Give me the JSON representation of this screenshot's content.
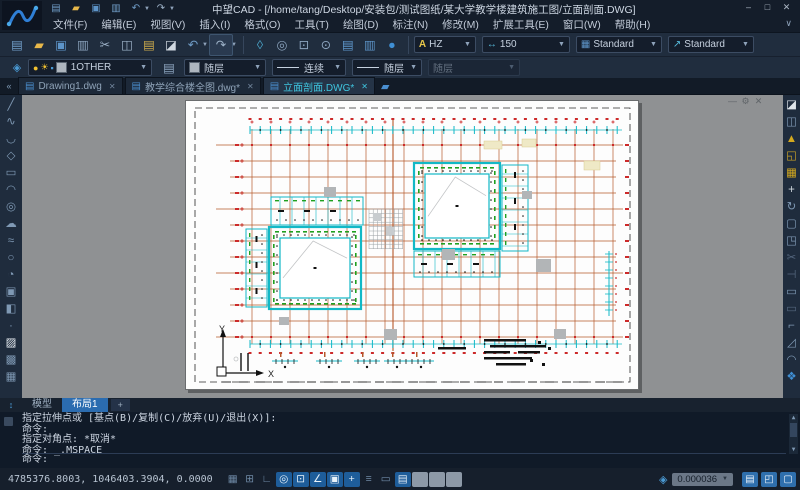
{
  "window": {
    "title": "中望CAD - [/home/tang/Desktop/安装包/测试图纸/某大学教学楼建筑施工图/立面剖面.DWG]",
    "controls": {
      "minimize": "–",
      "maximize": "□",
      "close": "✕"
    }
  },
  "quick_access": [
    {
      "id": "new-file",
      "g": "▤",
      "c": "#6f9cc6"
    },
    {
      "id": "open",
      "g": "▰",
      "c": "#e8b84a"
    },
    {
      "id": "save",
      "g": "▣",
      "c": "#5d94c8"
    },
    {
      "id": "plot",
      "g": "▥",
      "c": "#6f9cc6"
    },
    {
      "id": "undo",
      "g": "↶",
      "c": "#6f9cc6",
      "dd": true
    },
    {
      "id": "redo",
      "g": "↷",
      "c": "#9db2c8",
      "dd": true
    }
  ],
  "menu": {
    "items": [
      {
        "id": "file",
        "label": "文件(F)"
      },
      {
        "id": "edit",
        "label": "编辑(E)"
      },
      {
        "id": "view",
        "label": "视图(V)"
      },
      {
        "id": "insert",
        "label": "插入(I)"
      },
      {
        "id": "format",
        "label": "格式(O)"
      },
      {
        "id": "tools",
        "label": "工具(T)"
      },
      {
        "id": "draw",
        "label": "绘图(D)"
      },
      {
        "id": "dimension",
        "label": "标注(N)"
      },
      {
        "id": "modify",
        "label": "修改(M)"
      },
      {
        "id": "express",
        "label": "扩展工具(E)"
      },
      {
        "id": "window",
        "label": "窗口(W)"
      },
      {
        "id": "help",
        "label": "帮助(H)"
      }
    ]
  },
  "toolbar2": {
    "icons": [
      {
        "id": "new-file",
        "g": "▤",
        "c": "#6f9cc6"
      },
      {
        "id": "open",
        "g": "▰",
        "c": "#e8b84a"
      },
      {
        "id": "save",
        "g": "▣",
        "c": "#5d94c8"
      },
      {
        "id": "plot",
        "g": "▥",
        "c": "#8ba3bd"
      },
      {
        "id": "cut",
        "g": "✂",
        "c": "#9db2c8"
      },
      {
        "id": "copy",
        "g": "◫",
        "c": "#9db2c8"
      },
      {
        "id": "paste",
        "g": "▤",
        "c": "#c9a84c"
      },
      {
        "id": "match-properties",
        "g": "◪",
        "c": "#d0d8e0"
      },
      {
        "id": "undo",
        "g": "↶",
        "c": "#6f9cc6",
        "dd": true
      },
      {
        "id": "redo",
        "g": "↷",
        "c": "#9db2c8",
        "dd": true,
        "boxed": true
      },
      {
        "t": "sep"
      },
      {
        "id": "purge",
        "g": "◊",
        "c": "#4aa3c8"
      },
      {
        "id": "zoom-extents",
        "g": "◎",
        "c": "#8ba3bd"
      },
      {
        "id": "zoom-window",
        "g": "⊡",
        "c": "#8ba3bd"
      },
      {
        "id": "zoom-previous",
        "g": "⊙",
        "c": "#8ba3bd"
      },
      {
        "id": "properties-panel",
        "g": "▤",
        "c": "#5d94c8"
      },
      {
        "id": "sheet-set",
        "g": "▥",
        "c": "#5d94c8"
      },
      {
        "id": "design-center",
        "g": "●",
        "c": "#3f8fd4"
      },
      {
        "t": "sep"
      }
    ],
    "text_style": "HZ",
    "dim_style": "150",
    "table_style": "Standard",
    "mleader_style": "Standard"
  },
  "propsbar": {
    "layer": "1OTHER",
    "color": "随层",
    "linetype": "连续",
    "lineweight": "随层",
    "plot_style": "随层"
  },
  "doc_tabs": {
    "tabs": [
      {
        "id": "drawing1",
        "label": "Drawing1.dwg",
        "active": false
      },
      {
        "id": "jiaoxue-quantu",
        "label": "教学综合楼全图.dwg*",
        "active": false
      },
      {
        "id": "limian-poumian",
        "label": "立面剖面.DWG*",
        "active": true
      }
    ],
    "close_glyph": "✕"
  },
  "left_toolbar": [
    {
      "id": "line",
      "g": "╱"
    },
    {
      "id": "polyline",
      "g": "∿"
    },
    {
      "id": "arc-3point",
      "g": "◡"
    },
    {
      "id": "polygon",
      "g": "◇"
    },
    {
      "id": "rectangle",
      "g": "▭"
    },
    {
      "id": "arc",
      "g": "◠"
    },
    {
      "id": "circle",
      "g": "◎"
    },
    {
      "id": "revision-cloud",
      "g": "☁"
    },
    {
      "id": "spline",
      "g": "≈"
    },
    {
      "id": "ellipse",
      "g": "○"
    },
    {
      "id": "ellipse-arc",
      "g": "◔"
    },
    {
      "id": "insert-block",
      "g": "▣"
    },
    {
      "id": "make-block",
      "g": "◧"
    },
    {
      "id": "point",
      "g": "∙"
    },
    {
      "id": "hatch",
      "g": "▨",
      "c": "#e8eef4"
    },
    {
      "id": "gradient",
      "g": "▩"
    },
    {
      "id": "table",
      "g": "▦"
    }
  ],
  "right_toolbar": [
    {
      "id": "erase",
      "g": "◪",
      "c": "#dfe5ea"
    },
    {
      "id": "copy",
      "g": "◫"
    },
    {
      "id": "mirror",
      "g": "▲",
      "c": "#d4a91f"
    },
    {
      "id": "offset",
      "g": "◱",
      "c": "#c9a227"
    },
    {
      "id": "array",
      "g": "▦",
      "c": "#d4a91f"
    },
    {
      "id": "move",
      "g": "+",
      "c": "#cfd6dd"
    },
    {
      "id": "rotate",
      "g": "↻"
    },
    {
      "id": "scale",
      "g": "▢"
    },
    {
      "id": "stretch",
      "g": "◳"
    },
    {
      "id": "trim",
      "g": "✂",
      "c": "#55677e"
    },
    {
      "id": "extend",
      "g": "⊣",
      "c": "#55677e"
    },
    {
      "id": "break-at-point",
      "g": "▭"
    },
    {
      "id": "break",
      "g": "▭",
      "c": "#55677e"
    },
    {
      "id": "join",
      "g": "⌐"
    },
    {
      "id": "chamfer",
      "g": "◿"
    },
    {
      "id": "fillet",
      "g": "◠"
    },
    {
      "id": "explode",
      "g": "❖",
      "c": "#3f8fd4"
    }
  ],
  "layout_tabs": {
    "tabs": [
      {
        "id": "model",
        "label": "模型",
        "active": false
      },
      {
        "id": "layout1",
        "label": "布局1",
        "active": true
      }
    ],
    "add_label": "+"
  },
  "command": {
    "history": [
      "指定拉伸点或 [基点(B)/复制(C)/放弃(U)/退出(X)]:",
      "命令:",
      "指定对角点: *取消*",
      "命令: _.MSPACE"
    ],
    "prompt": "命令:"
  },
  "status": {
    "coordinates": "4785376.8003, 1046403.3904, 0.0000",
    "viewport_scale": "0.000036",
    "toggles": [
      {
        "id": "grid",
        "g": "▦",
        "s": "off"
      },
      {
        "id": "snap",
        "g": "⊞",
        "s": "off"
      },
      {
        "id": "ortho",
        "g": "∟",
        "s": "off"
      },
      {
        "id": "osnap",
        "g": "◎",
        "s": "on"
      },
      {
        "id": "object-track",
        "g": "⊡",
        "s": "on"
      },
      {
        "id": "polar",
        "g": "∠",
        "s": "on"
      },
      {
        "id": "image-frame",
        "g": "▣",
        "s": "on"
      },
      {
        "id": "dynamic-input",
        "g": "+",
        "s": "on"
      },
      {
        "id": "lineweight-display",
        "g": "≡",
        "s": "off"
      },
      {
        "id": "selection-cycling",
        "g": "▭",
        "s": "off"
      },
      {
        "id": "paper-model",
        "g": "▤",
        "s": "on"
      },
      {
        "id": "toggle-a",
        "g": "",
        "s": "dis"
      },
      {
        "id": "toggle-b",
        "g": "",
        "s": "dis"
      },
      {
        "id": "toggle-c",
        "g": "",
        "s": "dis"
      }
    ]
  },
  "drawing": {
    "ucs": {
      "x_label": "X",
      "y_label": "Y"
    },
    "palette": {
      "axis": "#b5582a",
      "cyan": "#12b8c6",
      "green": "#1fa01f",
      "red": "#cc2a2a",
      "frame": "#2a2a2a",
      "grey": "#b2b5b7",
      "hatch": "#9aa0a4",
      "ink": "#111111",
      "pale_yellow": "#efe9c6",
      "sketch": "#c2c4c6"
    }
  }
}
